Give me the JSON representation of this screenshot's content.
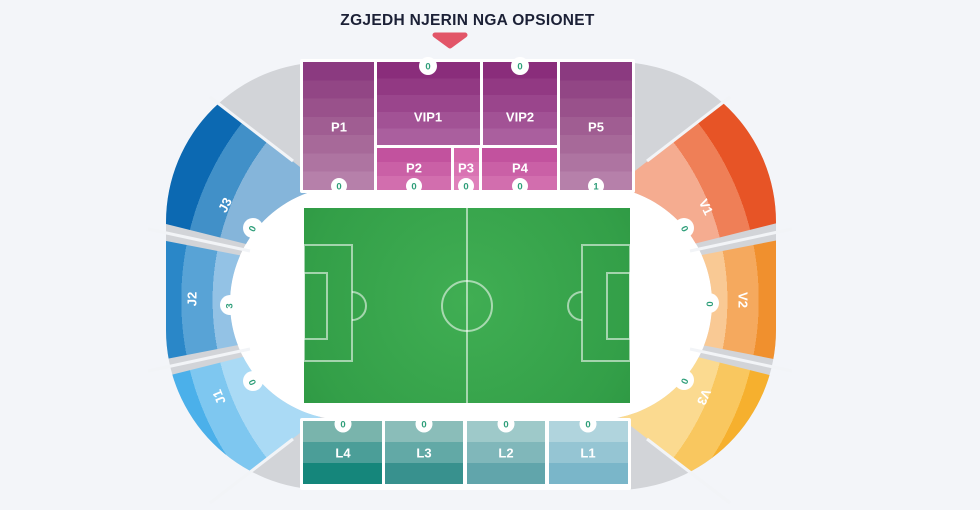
{
  "title": "ZGJEDH NJERIN NGA OPSIONET",
  "colors": {
    "background": "#f3f5f9",
    "title_text": "#1b2036",
    "arrow": "#e25568",
    "gray_ring": "#d2d4d8",
    "inner_concourse": "#ffffff",
    "pitch_green": "#2f9b45",
    "badge_number": "#2e9e79",
    "palette": {
      "p_sections_dark": "#8b3a80",
      "p_sections_light": "#b680aa",
      "vip_dark": "#8a2d7b",
      "vip_light": "#aa5f9e",
      "pink_dark": "#c2529e",
      "pink_light": "#d26eae",
      "j3": "#0c69b2",
      "j2": "#2a87c8",
      "j1": "#4bb0ea",
      "v1": "#e75426",
      "v2": "#f0902e",
      "v3": "#f6b02e",
      "l4": "#15867b",
      "l3": "#38918e",
      "l2": "#61a5ab",
      "l1": "#7ab6c9"
    }
  },
  "stands": {
    "north": [
      {
        "id": "P1",
        "label": "P1",
        "count": "0"
      },
      {
        "id": "VIP1",
        "label": "VIP1",
        "count": "0"
      },
      {
        "id": "VIP2",
        "label": "VIP2",
        "count": "0"
      },
      {
        "id": "P5",
        "label": "P5",
        "count": "1"
      },
      {
        "id": "P2",
        "label": "P2",
        "count": "0"
      },
      {
        "id": "P3",
        "label": "P3",
        "count": "0"
      },
      {
        "id": "P4",
        "label": "P4",
        "count": "0"
      }
    ],
    "west": [
      {
        "id": "J3",
        "label": "J3",
        "count": "0"
      },
      {
        "id": "J2",
        "label": "J2",
        "count": "3"
      },
      {
        "id": "J1",
        "label": "J1",
        "count": "0"
      }
    ],
    "east": [
      {
        "id": "V1",
        "label": "V1",
        "count": "0"
      },
      {
        "id": "V2",
        "label": "V2",
        "count": "0"
      },
      {
        "id": "V3",
        "label": "V3",
        "count": "0"
      }
    ],
    "south": [
      {
        "id": "L4",
        "label": "L4",
        "count": "0"
      },
      {
        "id": "L3",
        "label": "L3",
        "count": "0"
      },
      {
        "id": "L2",
        "label": "L2",
        "count": "0"
      },
      {
        "id": "L1",
        "label": "L1",
        "count": "0"
      }
    ]
  }
}
